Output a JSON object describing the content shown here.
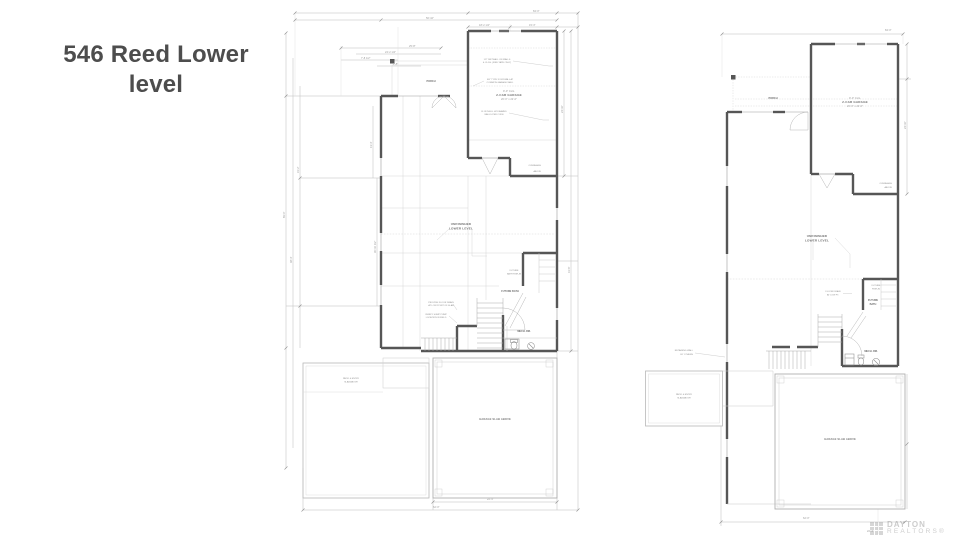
{
  "title": {
    "line1": "546 Reed Lower",
    "line2": "level"
  },
  "watermark": {
    "brand": "DAYTON",
    "subbrand": "REALTORS®"
  },
  "left": {
    "labels": {
      "porch": "PORCH",
      "clg": "9'-0\" CLG.",
      "garage": "2-CAR GARAGE",
      "size": "20'-0\" x 22'-0\"",
      "lvl1": "UNFINISHED",
      "lvl2": "LOWER LEVEL",
      "mech": "MECH. RM.",
      "bath": "FUTURE BATH",
      "lin1": "FUTURE",
      "lin2": "BATH RGH-IN",
      "oh1": "OVERHANG",
      "oh2": "ABOVE",
      "slabL1": "PATIO & ENTRY",
      "slabL2": "SLAB ABOVE",
      "slabG": "GARAGE SLAB ABOVE"
    },
    "notes": {
      "n1a": "1/2\" DRYWALL ON WALLS",
      "n1b": "& CLGS. (FIRE TAPE ONLY)",
      "n2a": "5/8\" TYPE X DRYWALL AT",
      "n2b": "COMMON GARAGE WALL",
      "n3a": "R-13 INSUL. AT FRAMED",
      "n3b": "WALLS PER CODE",
      "n4a": "PROVIDE FLOOR DRAIN",
      "n4b": "AT LOW POINT OF SLAB",
      "n5a": "VERIFY SUMP PUMP",
      "n5b": "LOCATION IN FIELD"
    },
    "dims": {
      "t1": "84'-0\"",
      "t2": "56'-10\"",
      "t3": "25'-8\"",
      "t4": "24'-2 1/2\"",
      "t5": "7'-8 1/2\"",
      "t6": "2'-8\"",
      "g1": "18'-2 1/2\"",
      "g2": "15'-3\"",
      "l1": "69'-0\"",
      "l2": "48'-4\"",
      "l3": "31'-2\"",
      "s1": "30'-10 1/2\"",
      "s2": "13'-4\"",
      "r1": "24'-10\"",
      "r2": "41'-6\"",
      "b1": "22'-4\"",
      "b2": "62'-0\""
    }
  },
  "right": {
    "labels": {
      "porch": "PORCH",
      "clg": "9'-0\" CLG.",
      "garage": "2-CAR GARAGE",
      "size": "20'-0\" x 22'-0\"",
      "lvl1": "UNFINISHED",
      "lvl2": "LOWER LEVEL",
      "mech": "MECH. RM.",
      "bath1": "FUTURE",
      "bath2": "BATH",
      "lin1": "FUTURE",
      "lin2": "RGH-IN",
      "oh1": "OVERHANG",
      "oh2": "ABOVE",
      "rw1": "RETAINING WALL",
      "rw2": "BY OTHERS",
      "slabL1": "PATIO & ENTRY",
      "slabL2": "SLAB ABOVE",
      "slabG": "GARAGE SLAB ABOVE"
    },
    "notes": {
      "n1a": "FLOOR DRAIN",
      "n1b": "AT LOW PT."
    },
    "dims": {
      "t1": "84'-0\"",
      "v1": "24'-10\"",
      "b1": "62'-0\"",
      "b2": "22'-4\""
    }
  }
}
